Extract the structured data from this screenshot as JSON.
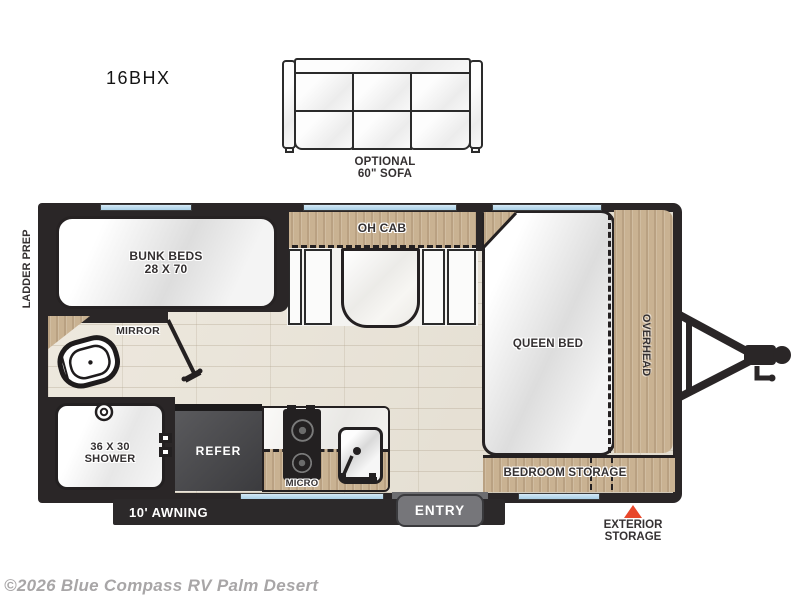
{
  "page": {
    "model": "16BHX",
    "copyright": "©2026 Blue Compass RV Palm Desert"
  },
  "sofa": {
    "caption_line1": "OPTIONAL",
    "caption_line2": "60\" SOFA"
  },
  "exterior": {
    "ladder_prep": "LADDER PREP",
    "awning": "10' AWNING",
    "entry": "ENTRY",
    "exterior_storage_line1": "EXTERIOR",
    "exterior_storage_line2": "STORAGE"
  },
  "rooms": {
    "bunk_line1": "BUNK BEDS",
    "bunk_line2": "28 X 70",
    "mirror": "MIRROR",
    "shower_line1": "36 X 30",
    "shower_line2": "SHOWER",
    "refer": "REFER",
    "micro": "MICRO",
    "oh_cab": "OH CAB",
    "queen_bed": "QUEEN BED",
    "overhead": "OVERHEAD",
    "bedroom_storage": "BEDROOM STORAGE"
  },
  "colors": {
    "wall": "#2a2627",
    "wood": "#c9b292",
    "floor": "#e9e4da",
    "window_blue": "#b5d7ea",
    "refer_box": "#48484a",
    "entry_badge": "#76767a",
    "awning_bar": "#2c292a",
    "exterior_storage_red": "#e8472b",
    "label_text": "#343031",
    "copyright_gray": "#a8a6a7"
  }
}
